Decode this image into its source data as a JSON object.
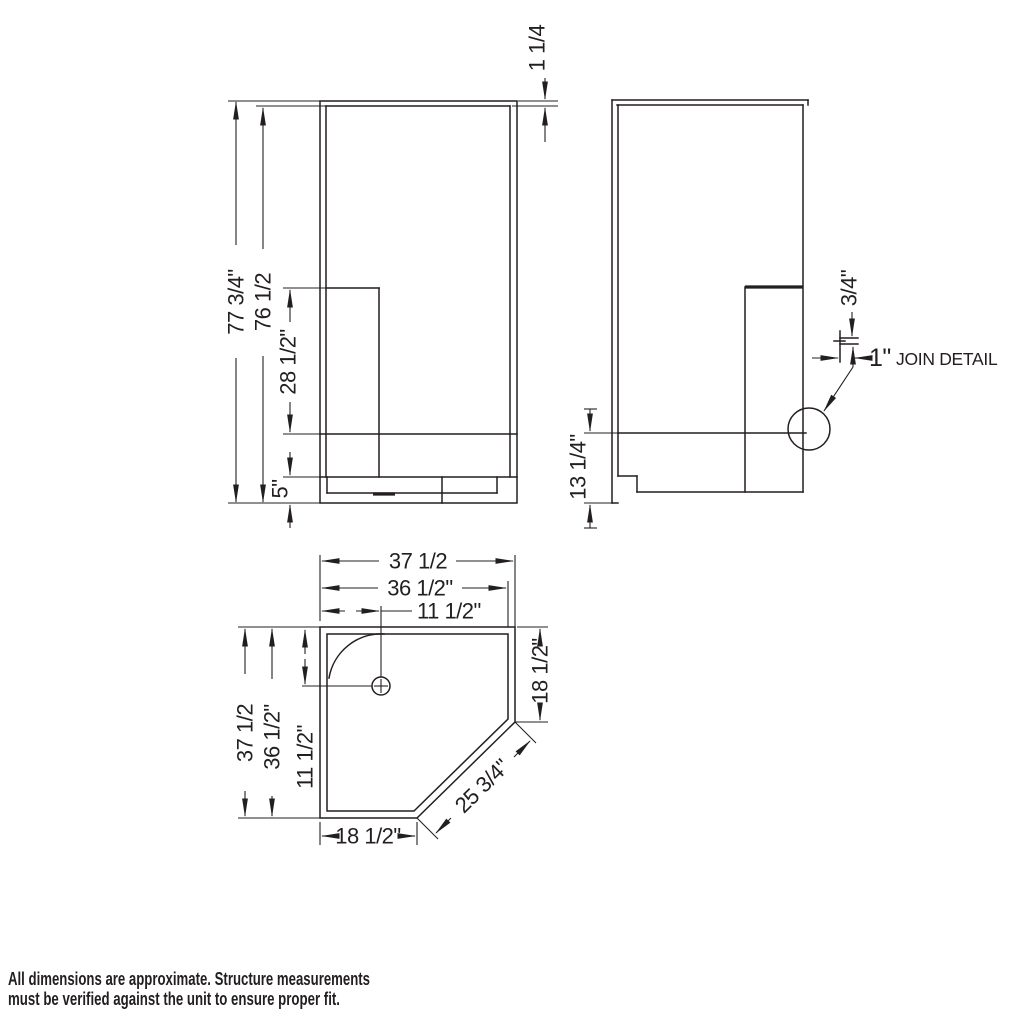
{
  "front_view": {
    "dims": {
      "overall_height": "77 3/4\"",
      "inner_height": "76 1/2",
      "seat_height": "28 1/2\"",
      "base_height": "5\"",
      "top_rail": "1 1/4"
    }
  },
  "side_view": {
    "dims": {
      "ledge_height": "13 1/4\"",
      "join_thickness": "3/4\"",
      "join_width": "1\"",
      "join_label": "JOIN DETAIL"
    }
  },
  "plan_view": {
    "dims": {
      "overall_width": "37 1/2",
      "inner_width": "36 1/2\"",
      "drain_offset_h": "11 1/2\"",
      "overall_depth": "37 1/2",
      "inner_depth": "36 1/2\"",
      "drain_offset_v": "11 1/2\"",
      "right_return": "18 1/2\"",
      "front_return": "18 1/2\"",
      "diagonal_front": "25 3/4\""
    }
  },
  "footer": {
    "line1": "All dimensions are approximate. Structure measurements",
    "line2": "must be verified against the unit to ensure proper fit."
  },
  "colors": {
    "line": "#231f20",
    "background": "#ffffff"
  }
}
